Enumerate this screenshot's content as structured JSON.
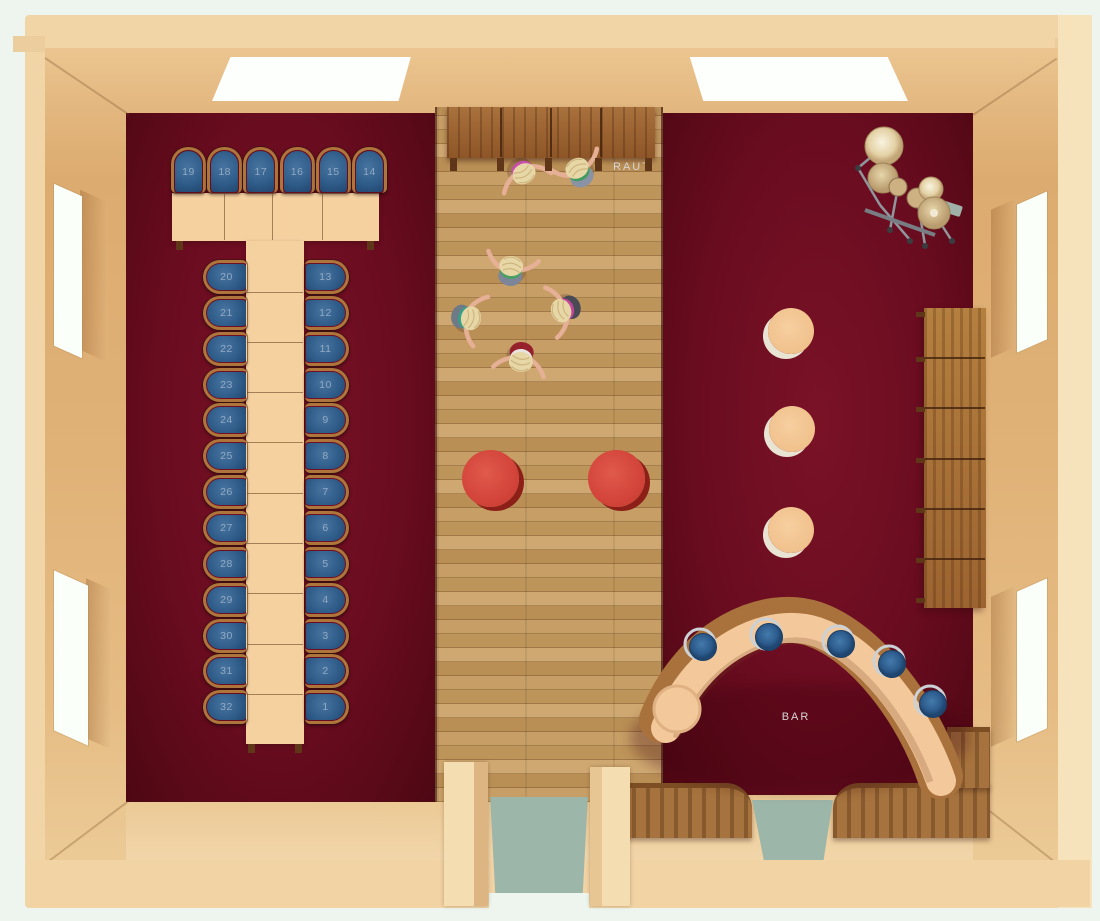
{
  "scene": {
    "type": "3d-floor-plan-render",
    "description": "Top-down render of an event hall with banquet seating, dance floor, bar and drum kit"
  },
  "labels": {
    "raut": "RAUT",
    "bar": "BAR"
  },
  "seating": {
    "head_row_numbers": [
      "19",
      "18",
      "17",
      "16",
      "15",
      "14"
    ],
    "left_column_numbers": [
      "20",
      "21",
      "22",
      "23",
      "24",
      "25",
      "26",
      "27",
      "28",
      "29",
      "30",
      "31",
      "32"
    ],
    "right_column_numbers": [
      "13",
      "12",
      "11",
      "10",
      "9",
      "8",
      "7",
      "6",
      "5",
      "4",
      "3",
      "2",
      "1"
    ],
    "total_seats": 32
  },
  "furniture": {
    "banquet_table_row_segments": 4,
    "banquet_table_column_segments": 10,
    "top_counter_segments": 4,
    "right_cabinet_segments": 6,
    "red_round_tables": 2,
    "beige_round_tables": 3,
    "bar_stools": 5,
    "drum_kit": true
  },
  "people": {
    "dancer_count": 6,
    "outfits": [
      {
        "top": "#c84fae",
        "skirt": ""
      },
      {
        "top": "#3f9b5f",
        "skirt": "#8a93a6"
      },
      {
        "top": "#4a9f63",
        "skirt": "#7d8698"
      },
      {
        "top": "#36a089",
        "skirt": "#6f7a86"
      },
      {
        "top": "#c2459c",
        "skirt": "#4a4a55"
      },
      {
        "top": "#e8e4e0",
        "skirt": "#96202c"
      }
    ]
  },
  "colors": {
    "carpet_maroon": "#6a0c20",
    "wood_floor": "#c49c62",
    "wall_beige": "#f2d5a6",
    "table_beige": "#f6d1a0",
    "chair_blue": "#2e5b88",
    "chair_frame_wood": "#ad753c",
    "seat_number": "#92a9c3",
    "red_table": "#d3443a",
    "stool_blue": "#336699",
    "teal_runner": "#9db6aa",
    "label_text": "#d6d6d6"
  }
}
